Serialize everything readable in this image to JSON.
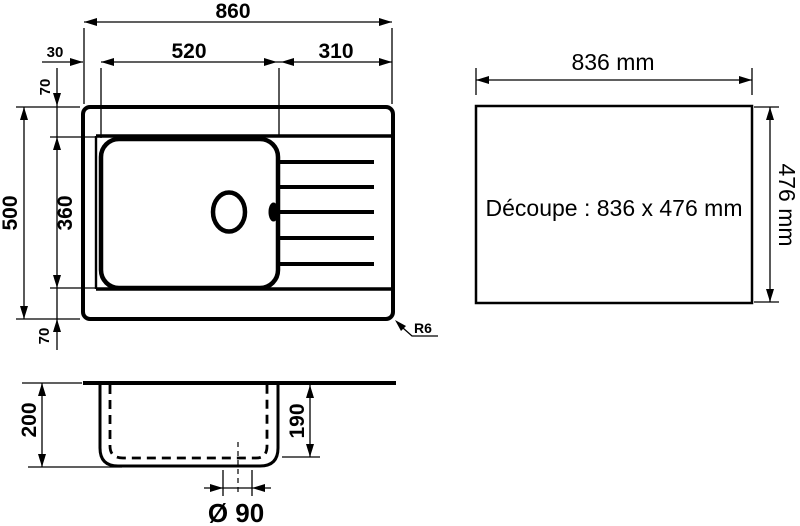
{
  "drawing_title": "Sink dimensional drawing",
  "top_view": {
    "overall_width": "860",
    "bowl_zone_width": "520",
    "drainer_width": "310",
    "left_rim": "30",
    "top_rim": "70",
    "overall_depth": "500",
    "bowl_depth": "360",
    "bottom_rim": "70",
    "corner_radius": "R6"
  },
  "cutout": {
    "width": "836 mm",
    "height": "476 mm",
    "label": "Découpe : 836 x 476 mm"
  },
  "section": {
    "overall_height": "200",
    "bowl_height": "190",
    "drain_diameter": "Ø 90"
  },
  "colors": {
    "ink": "#000000",
    "paper": "#ffffff"
  }
}
